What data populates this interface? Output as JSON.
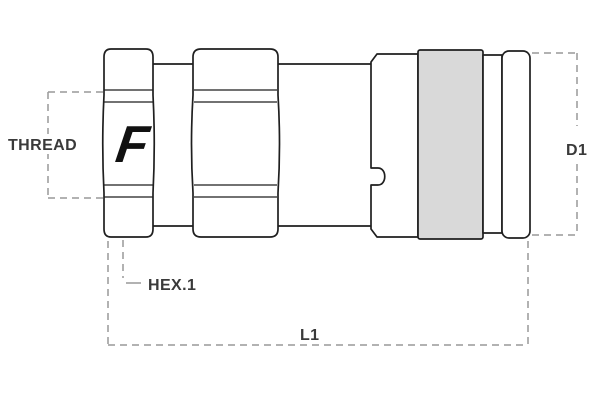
{
  "diagram": {
    "type": "technical-drawing",
    "subject": "hydraulic quick coupling, side view",
    "logo_letter": "F",
    "labels": {
      "thread": "THREAD",
      "hex1": "HEX.1",
      "d1": "D1",
      "l1": "L1"
    },
    "colors": {
      "outline": "#1f1f1f",
      "dimension_line": "#999999",
      "label_text": "#3a3a3a",
      "sleeve_fill": "#d9d9d9",
      "logo": "#111111",
      "background": "#ffffff"
    }
  }
}
